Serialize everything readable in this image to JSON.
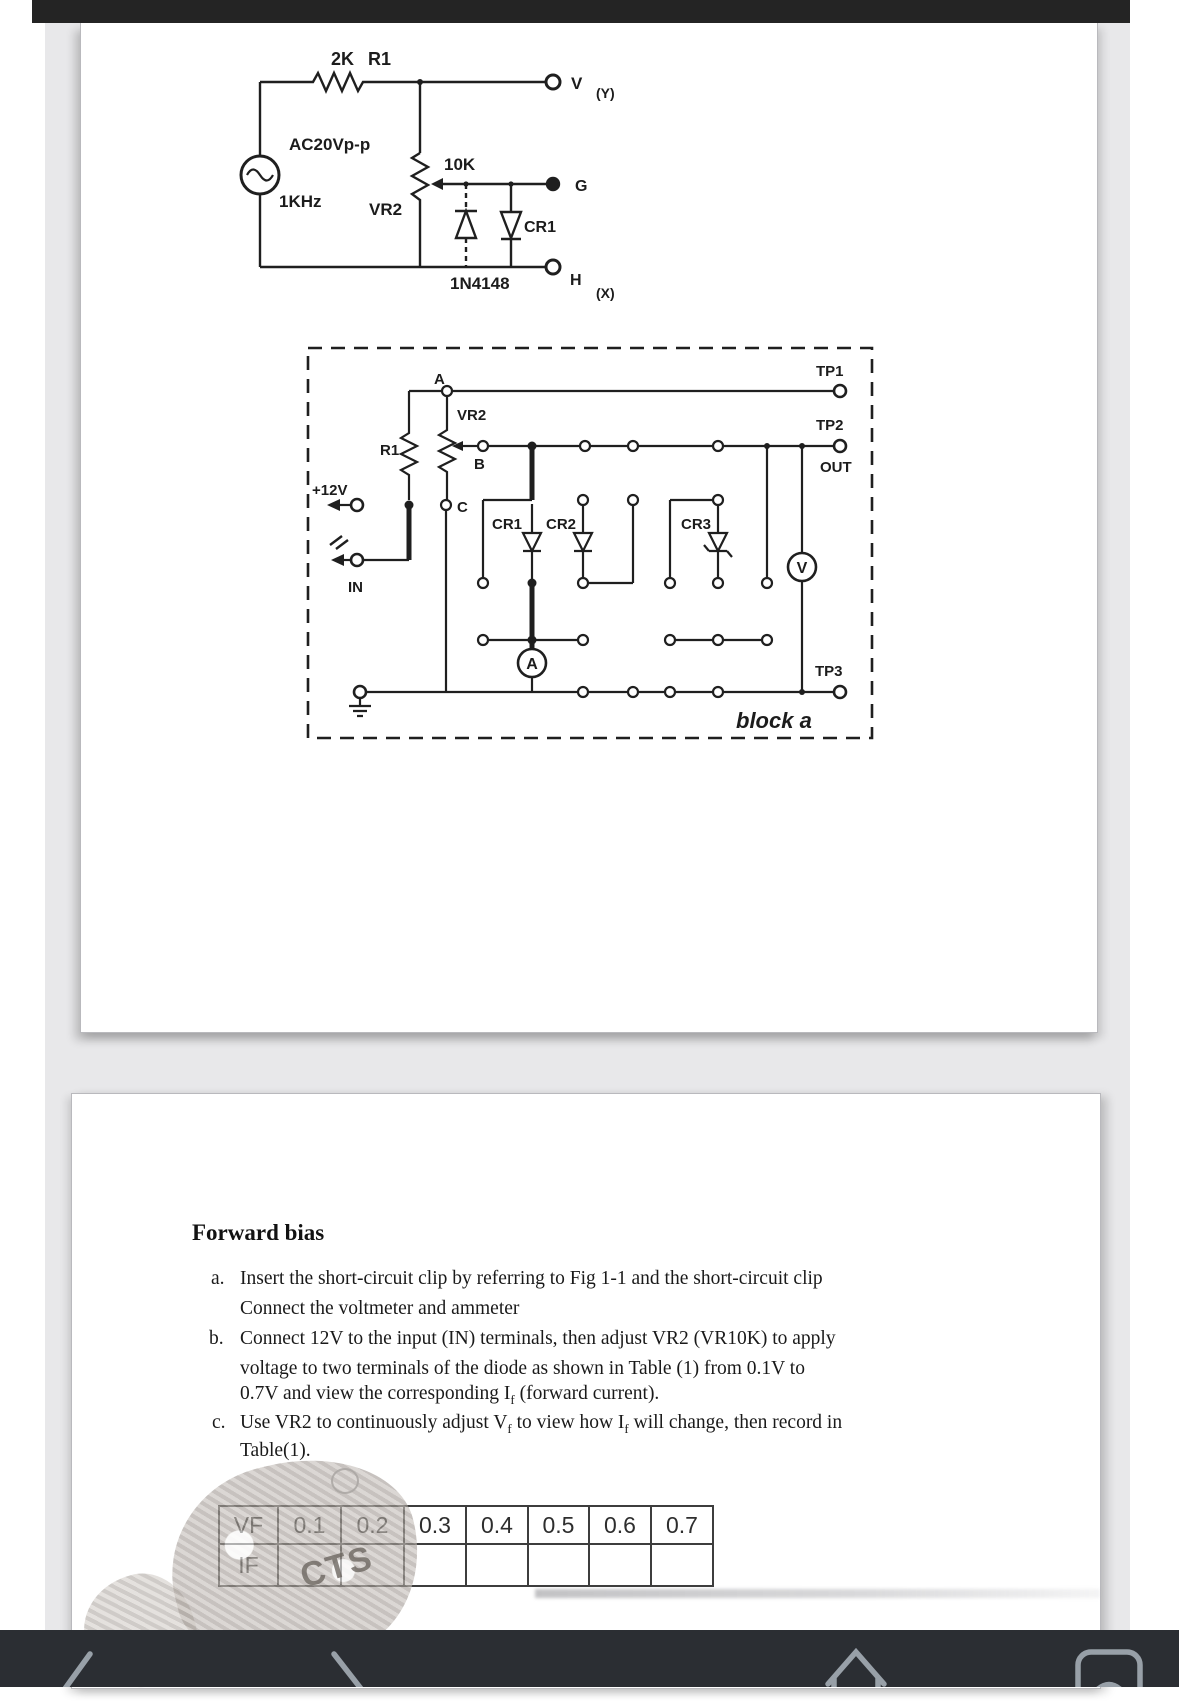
{
  "fig1": {
    "r1_value": "2K",
    "r1_name": "R1",
    "source_label": "AC20Vp-p",
    "source_freq": "1KHz",
    "pot_value": "10K",
    "pot_name": "VR2",
    "diode_name": "CR1",
    "diode_part": "1N4148",
    "term_v": "V",
    "term_v_sub": "(Y)",
    "term_g": "G",
    "term_h": "H",
    "term_h_sub": "(X)"
  },
  "fig2": {
    "tp1": "TP1",
    "tp2": "TP2",
    "out": "OUT",
    "tp3": "TP3",
    "node_a": "A",
    "node_b": "B",
    "node_c": "C",
    "vr2": "VR2",
    "r1": "R1",
    "plus12v": "+12V",
    "in_label": "IN",
    "cr1": "CR1",
    "cr2": "CR2",
    "cr3": "CR3",
    "ammeter": "A",
    "voltmeter": "V",
    "block_label": "block a"
  },
  "section": {
    "heading": "Forward bias",
    "a_marker": "a.",
    "a1": "Insert the short-circuit clip by referring to Fig 1-1 and the short-circuit clip",
    "a2": "Connect the voltmeter and ammeter",
    "b_marker": "b.",
    "b1": "Connect 12V to the input (IN) terminals, then adjust VR2 (VR10K) to apply",
    "b2": "voltage to two terminals of the diode as shown in Table (1) from 0.1V to",
    "b3_pre": "0.7V and view the corresponding I",
    "b3_sub": "f",
    "b3_post": " (forward current).",
    "c_marker": "c.",
    "c1_pre": "Use VR2 to continuously adjust V",
    "c1_sub1": "f",
    "c1_mid": " to view how I",
    "c1_sub2": "f",
    "c1_post": " will change, then record in",
    "c2": "Table(1)."
  },
  "table": {
    "rows": [
      [
        "VF",
        "0.1",
        "0.2",
        "0.3",
        "0.4",
        "0.5",
        "0.6",
        "0.7"
      ],
      [
        "IF",
        "",
        "",
        "",
        "",
        "",
        "",
        ""
      ]
    ]
  },
  "watermark": {
    "text": "CTS"
  },
  "colors": {
    "ink": "#1f1f1f",
    "topbar": "#242424",
    "navbar": "#2b2e33",
    "nav_icon": "#98a0a8",
    "viewer_bg": "#e8e8ea"
  }
}
